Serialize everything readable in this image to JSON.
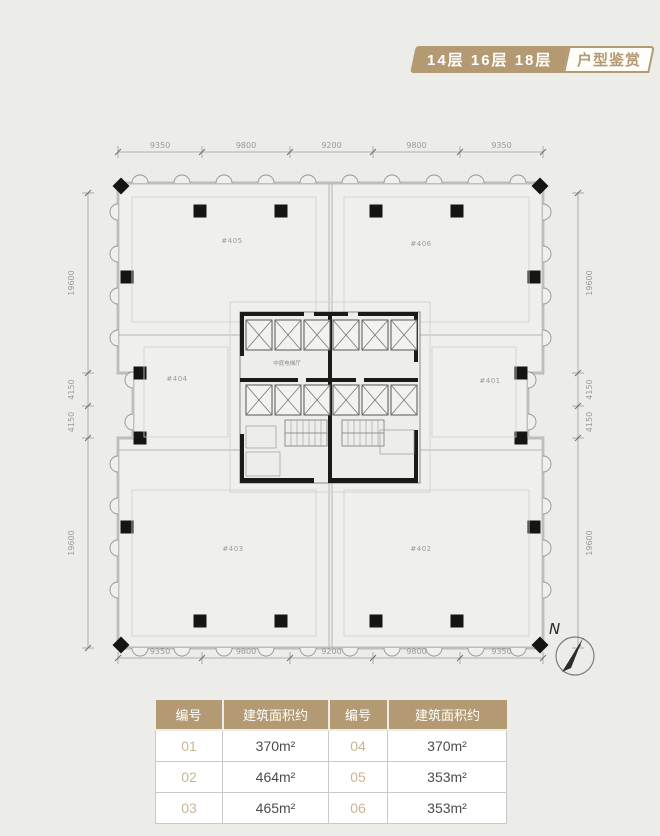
{
  "banner": {
    "floors": "14层 16层 18层",
    "tag": "户型鉴赏"
  },
  "colors": {
    "accent": "#b49a73",
    "page_bg": "#ecece9",
    "table_number_text": "#c9b693",
    "table_area_text": "#4c4c4c"
  },
  "floorplan": {
    "dims_top": [
      "9350",
      "9800",
      "9200",
      "9800",
      "9350"
    ],
    "dims_bottom": [
      "9350",
      "9800",
      "9200",
      "9800",
      "9350"
    ],
    "dims_left": [
      "19600",
      "4150",
      "4150",
      "19600"
    ],
    "dims_right": [
      "19600",
      "4150",
      "4150",
      "19600"
    ],
    "units": [
      {
        "label": "#405"
      },
      {
        "label": "#406"
      },
      {
        "label": "#404"
      },
      {
        "label": "#401"
      },
      {
        "label": "#403"
      },
      {
        "label": "#402"
      }
    ],
    "core_label": "中庭电梯厅",
    "north_label": "N"
  },
  "table": {
    "headers": [
      "编号",
      "建筑面积约",
      "编号",
      "建筑面积约"
    ],
    "rows": [
      [
        "01",
        "370m²",
        "04",
        "370m²"
      ],
      [
        "02",
        "464m²",
        "05",
        "353m²"
      ],
      [
        "03",
        "465m²",
        "06",
        "353m²"
      ]
    ]
  }
}
